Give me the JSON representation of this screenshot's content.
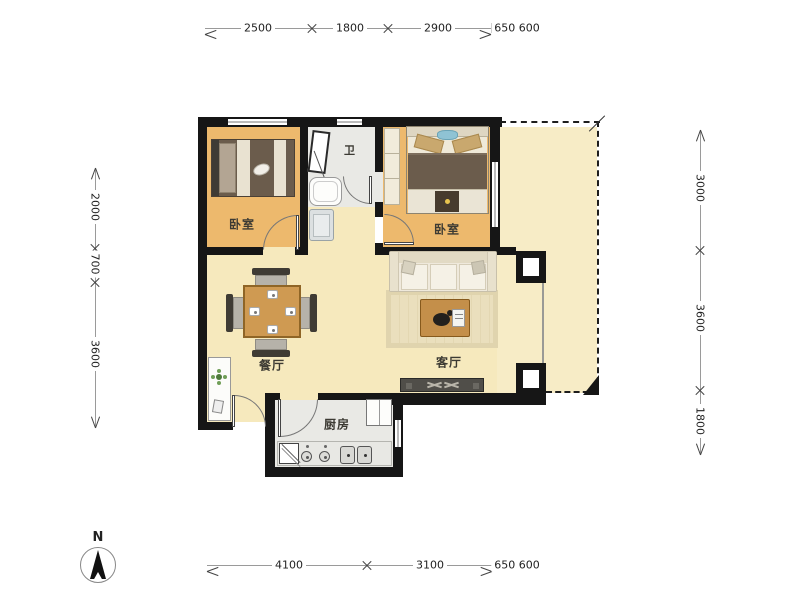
{
  "plan": {
    "type": "residential-floor-plan",
    "north_label": "N",
    "rooms": [
      {
        "id": "bedroom-1",
        "label": "卧室"
      },
      {
        "id": "bathroom",
        "label": "卫"
      },
      {
        "id": "bedroom-2",
        "label": "卧室"
      },
      {
        "id": "dining-room",
        "label": "餐厅"
      },
      {
        "id": "living-room",
        "label": "客厅"
      },
      {
        "id": "kitchen",
        "label": "厨房"
      }
    ]
  },
  "dimensions": {
    "top": [
      {
        "label": "2500"
      },
      {
        "label": "1800"
      },
      {
        "label": "2900"
      },
      {
        "label": "650 600"
      }
    ],
    "bottom": [
      {
        "label": "4100"
      },
      {
        "label": "3100"
      },
      {
        "label": "650 600"
      }
    ],
    "left": [
      {
        "label": "2000"
      },
      {
        "label": "700"
      },
      {
        "label": "3600"
      }
    ],
    "right": [
      {
        "label": "3000"
      },
      {
        "label": "3600"
      },
      {
        "label": "1800"
      }
    ]
  },
  "colors": {
    "wall": "#161616",
    "bedroom_floor": "#edb96d",
    "living_floor": "#f6e9bd",
    "wet_floor": "#e9e9e5",
    "dim_line": "#9a9a9a",
    "dim_text": "#222222"
  }
}
